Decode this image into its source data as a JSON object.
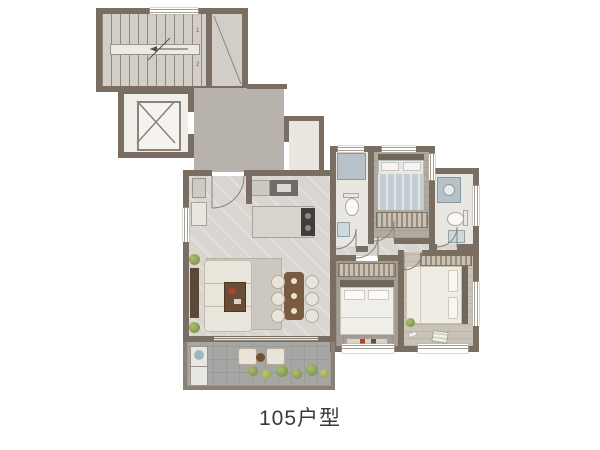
{
  "title": {
    "caption": "105户型"
  },
  "stairwell": {
    "marks": [
      "1",
      "2"
    ]
  },
  "colors": {
    "wall": "#7a6e62",
    "marble_floor": "#d9d5d0",
    "corridor_floor": "#b7b2ab",
    "stair_floor": "#d2cec7",
    "bedroom_wood": "#a49d93",
    "master_wood": "#c9c2b6",
    "balcony_tile": "#a6a6a4",
    "fixture_blue": "#b6c2c8",
    "sofa_cream": "#eae5da",
    "furniture_brown": "#7a5a40",
    "plant_green": "#7e9b54",
    "caption_text": "#3a3a3a"
  }
}
